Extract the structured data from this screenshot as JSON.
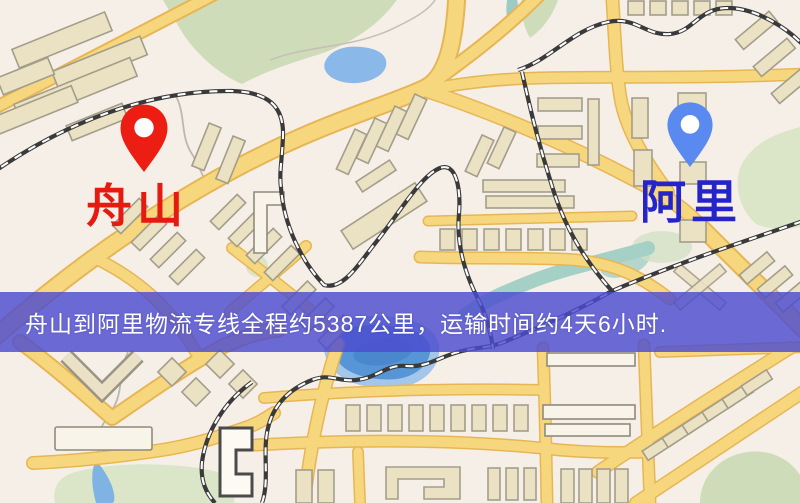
{
  "banner": {
    "text": "舟山到阿里物流专线全程约5387公里，运输时间约4天6小时.",
    "background_color": "#4c4cd0",
    "text_color": "#ffffff"
  },
  "origin": {
    "name": "舟山",
    "label_color": "#e51a10",
    "pin_color": "#ec1d12"
  },
  "destination": {
    "name": "阿里",
    "label_color": "#2424c8",
    "pin_color": "#5a8aef"
  },
  "route": {
    "distance": "5387公里",
    "duration": "4天6小时"
  },
  "map_palette": {
    "background": "#f6efe8",
    "road_fill": "#f6d77e",
    "road_casing": "#e7b654",
    "building_fill": "#ebe2c4",
    "park_green": "#cedcba",
    "water_blue": "#5796d6",
    "railway_black": "#3a3a3a"
  }
}
